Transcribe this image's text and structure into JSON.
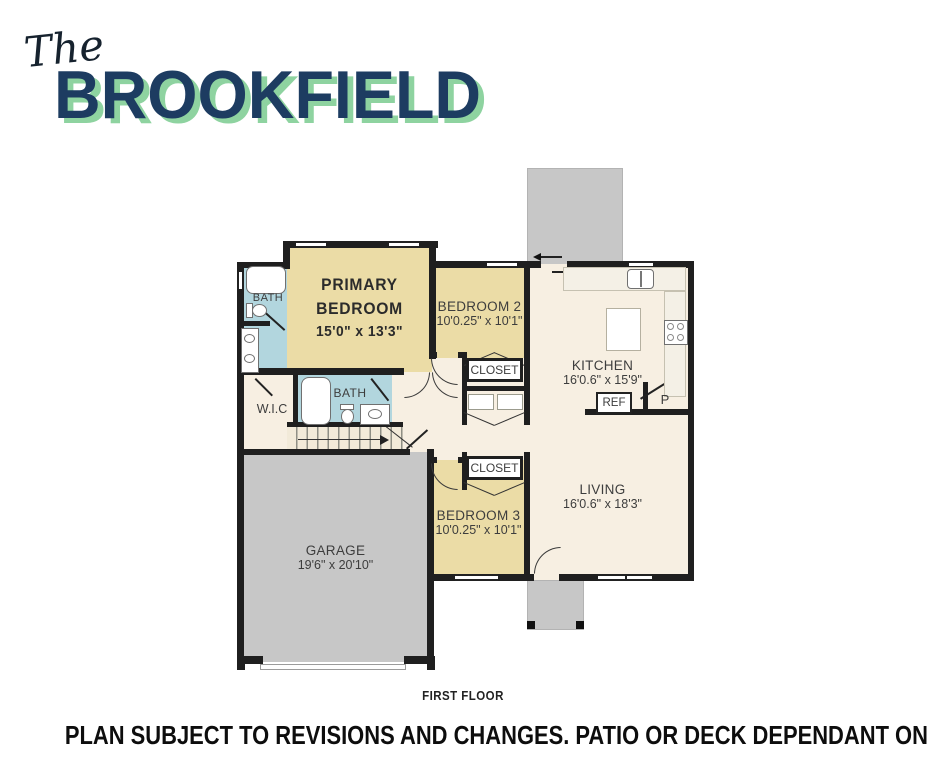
{
  "title": {
    "the": "The",
    "name": "BROOKFIELD"
  },
  "plan": {
    "primary_bedroom": {
      "line1": "PRIMARY",
      "line2": "BEDROOM",
      "dims": "15'0\" x 13'3\""
    },
    "bedroom2": {
      "name": "BEDROOM 2",
      "dims": "10'0.25\" x 10'1\""
    },
    "bedroom3": {
      "name": "BEDROOM 3",
      "dims": "10'0.25\" x 10'1\""
    },
    "kitchen": {
      "name": "KITCHEN",
      "dims": "16'0.6\" x 15'9\""
    },
    "living": {
      "name": "LIVING",
      "dims": "16'0.6\" x 18'3\""
    },
    "garage": {
      "name": "GARAGE",
      "dims": "19'6\" x 20'10\""
    },
    "bath_primary": {
      "name": "BATH"
    },
    "bath_hall": {
      "name": "BATH"
    },
    "wic": {
      "name": "W.I.C"
    },
    "closet_hall": {
      "name": "CLOSET"
    },
    "closet_bed3": {
      "name": "CLOSET"
    },
    "fridge": {
      "name": "REF"
    },
    "pantry": {
      "name": "P"
    }
  },
  "footer": {
    "floor": "FIRST FLOOR",
    "disclaimer": "PLAN SUBJECT TO REVISIONS AND CHANGES. PATIO OR DECK DEPENDANT ON LOT GRADE"
  },
  "colors": {
    "navy": "#1d3c61",
    "green": "#8ed3a0",
    "wall": "#1f1f1f",
    "bedroom_fill": "#ebdca6",
    "bath_fill": "#b2d6de",
    "floor_fill": "#f7efe2",
    "garage_fill": "#c7c7c7"
  }
}
